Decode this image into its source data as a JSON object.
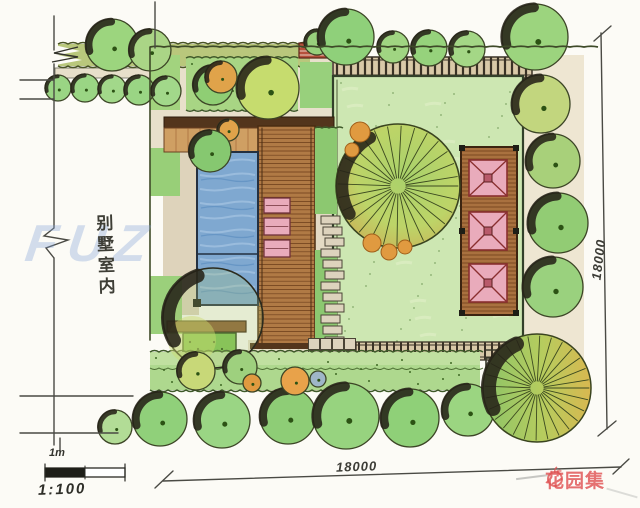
{
  "site_label": {
    "text": "别墅室内",
    "chars": [
      "别",
      "墅",
      "室",
      "内"
    ]
  },
  "dimensions": {
    "bottom": "18000",
    "right": "18000"
  },
  "scale": {
    "bar_label": "1m",
    "ratio": "1:100"
  },
  "watermark": {
    "text": "FUZ"
  },
  "logo": {
    "text": "花园集",
    "icon": "apple-icon",
    "color": "#df5252"
  },
  "colors": {
    "paper": "#fcfbf6",
    "lawn_green": "#cde7b2",
    "tree_green": "#8fd07a",
    "olive_green": "#c2d67e",
    "orange_tree": "#e0a34a",
    "pool_blue": "#7fa8d0",
    "deck_brown": "#b07a45",
    "dark_wood": "#53351c",
    "paving_tan": "#e7dfca",
    "pink_furniture": "#e9abbb",
    "red_bench": "#b6503c",
    "outline_dark": "#3c4526",
    "dimension_line": "#4a4a44",
    "logo_red": "#df5252",
    "watermark_blue": "#80a2d6"
  }
}
